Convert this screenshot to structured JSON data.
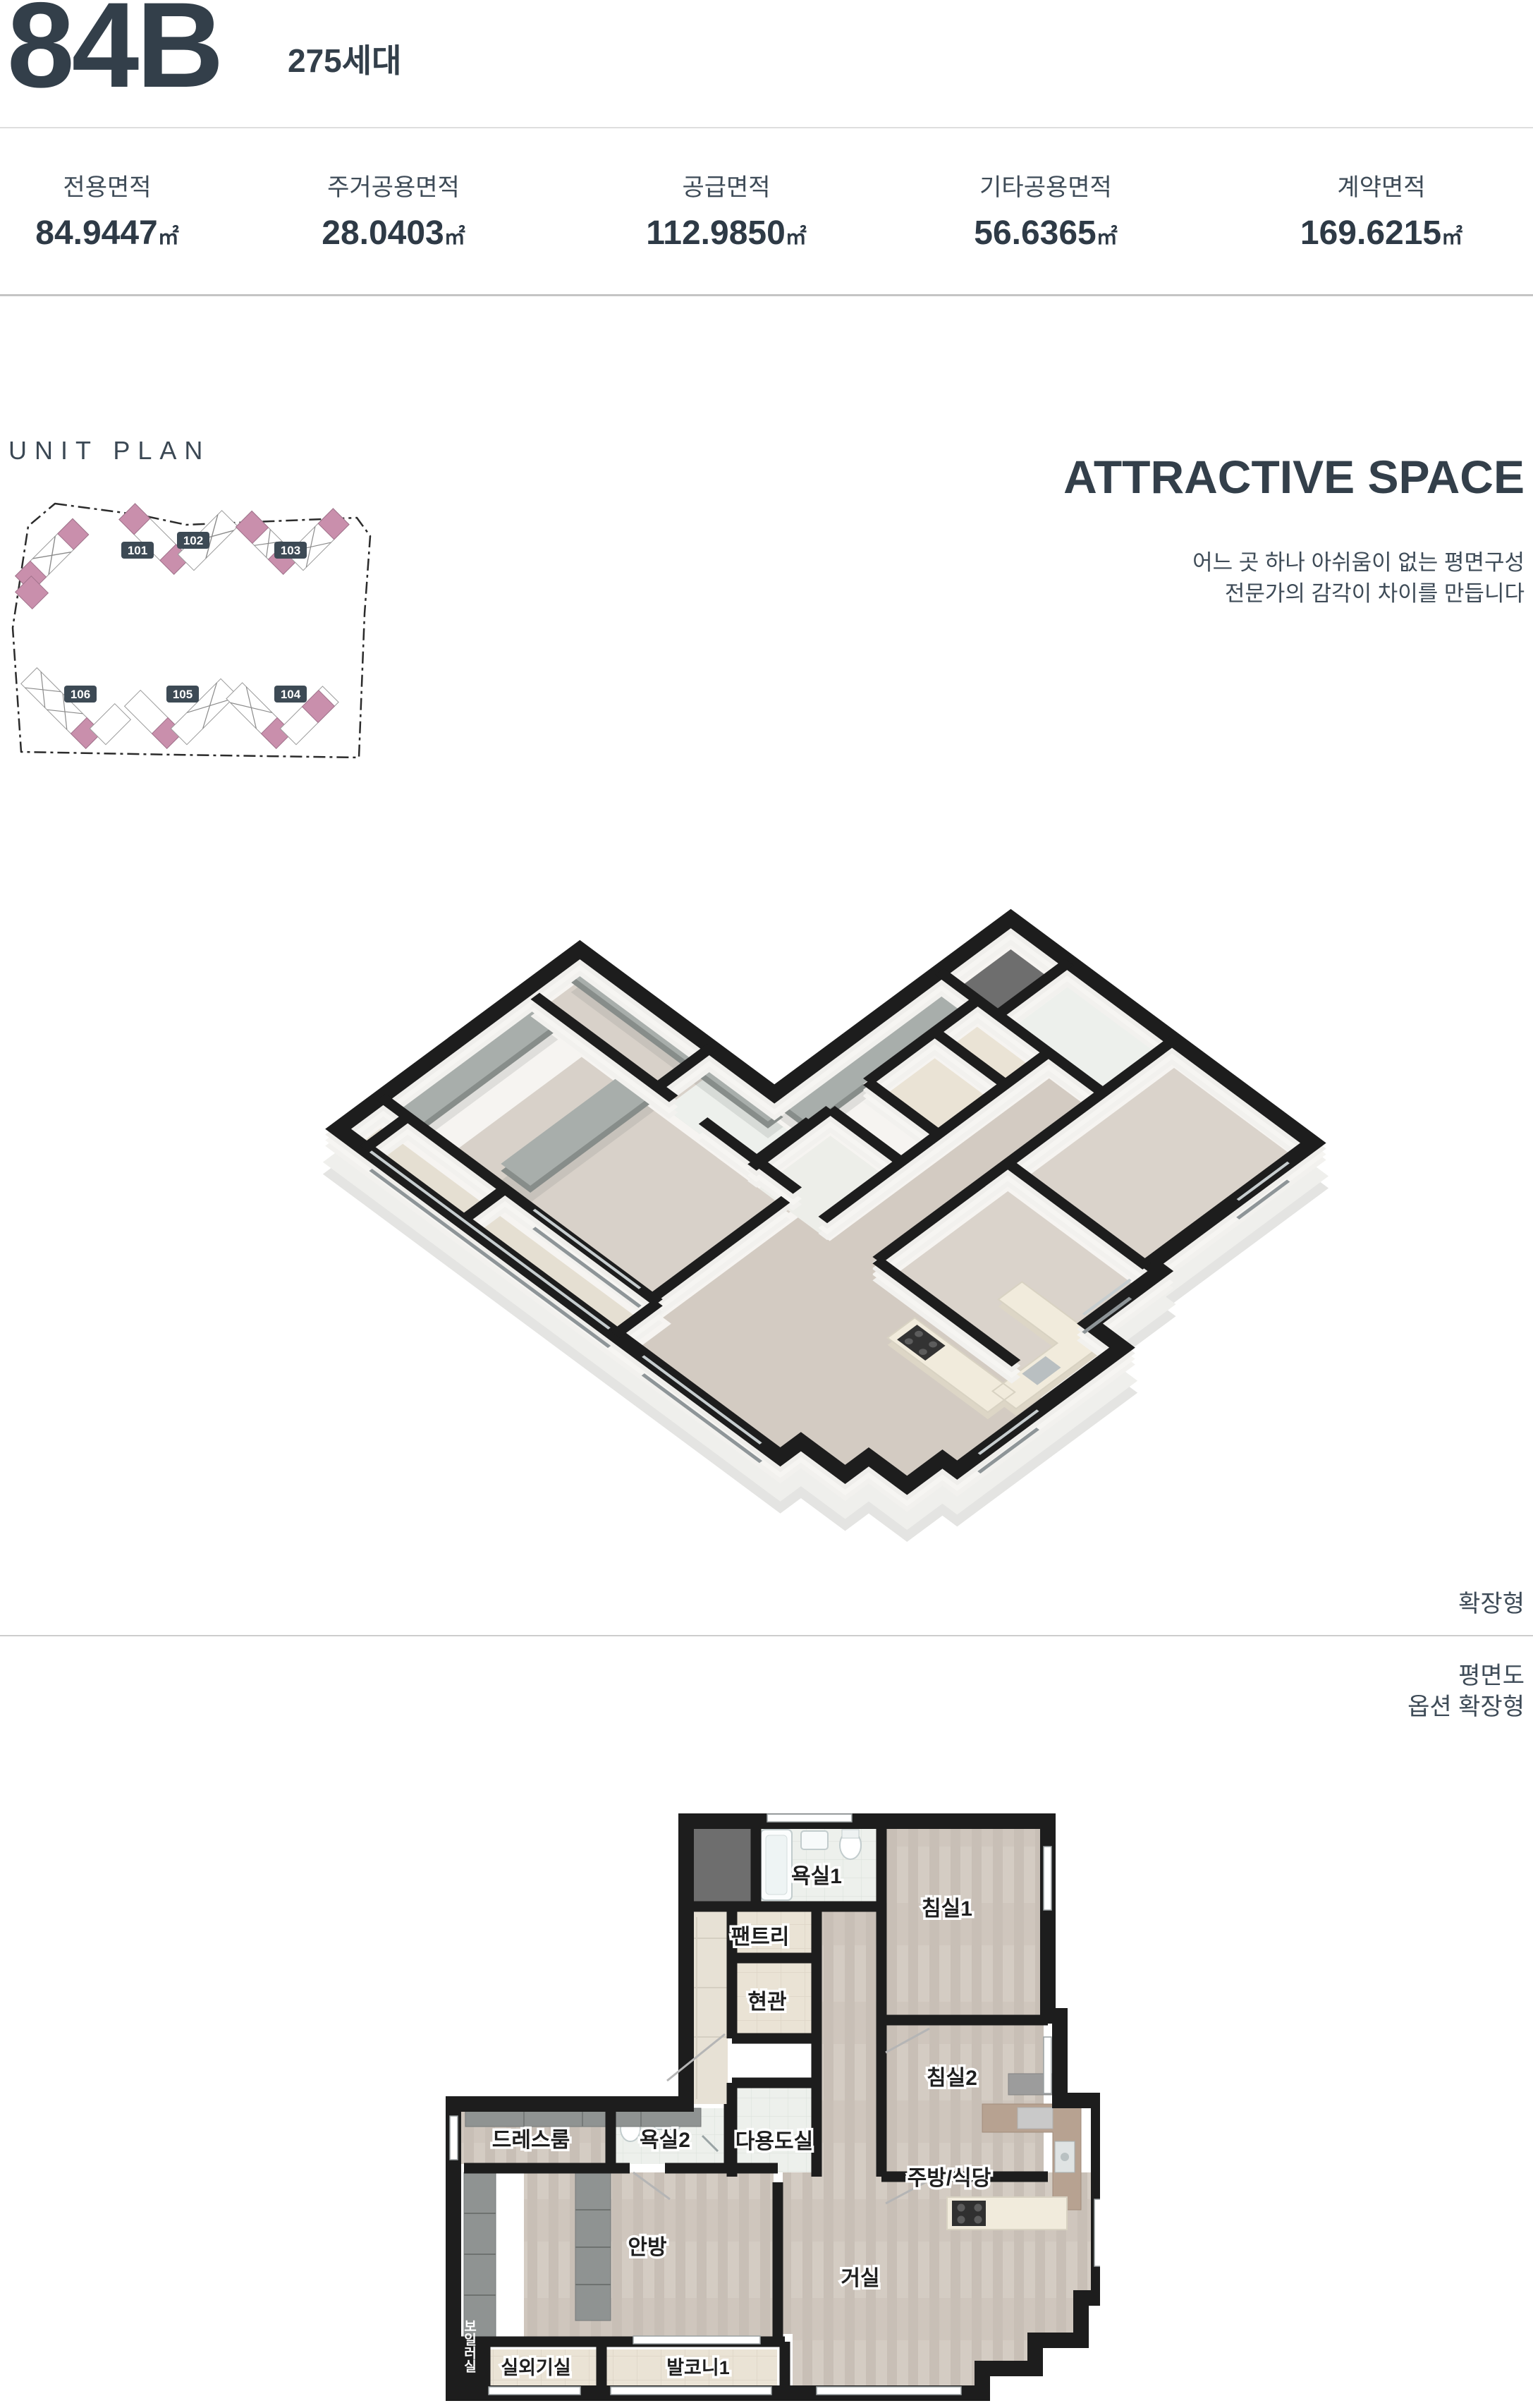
{
  "header": {
    "unit_type": "84B",
    "households": "275세대"
  },
  "areas": {
    "unit": "㎡",
    "items": [
      {
        "label": "전용면적",
        "value": "84.9447"
      },
      {
        "label": "주거공용면적",
        "value": "28.0403"
      },
      {
        "label": "공급면적",
        "value": "112.9850"
      },
      {
        "label": "기타공용면적",
        "value": "56.6365"
      },
      {
        "label": "계약면적",
        "value": "169.6215"
      }
    ]
  },
  "unit_plan": {
    "title": "UNIT PLAN",
    "buildings": [
      "101",
      "102",
      "103",
      "106",
      "105",
      "104"
    ]
  },
  "attractive": {
    "title": "ATTRACTIVE SPACE",
    "subtitle_line1": "어느 곳 하나 아쉬움이 없는 평면구성",
    "subtitle_line2": "전문가의 감각이 차이를 만듭니다"
  },
  "floor3d": {
    "tag": "확장형"
  },
  "floor2d": {
    "note_line1": "평면도",
    "note_line2": "옵션 확장형",
    "rooms": {
      "bath1": "욕실1",
      "bed1": "침실1",
      "pantry": "팬트리",
      "entrance": "현관",
      "bed2": "침실2",
      "utility": "다용도실",
      "dress": "드레스룸",
      "bath2": "욕실2",
      "kitchen": "주방/식당",
      "master": "안방",
      "living": "거실",
      "outdoor_unit": "실외기실",
      "balcony1": "발코니1",
      "boiler": "보일러실"
    }
  },
  "colors": {
    "accent_slate": "#333f4a",
    "badge": "#3d4a55",
    "unit_highlight_pink": "#c98fac",
    "wall_black": "#1d1d1d"
  }
}
